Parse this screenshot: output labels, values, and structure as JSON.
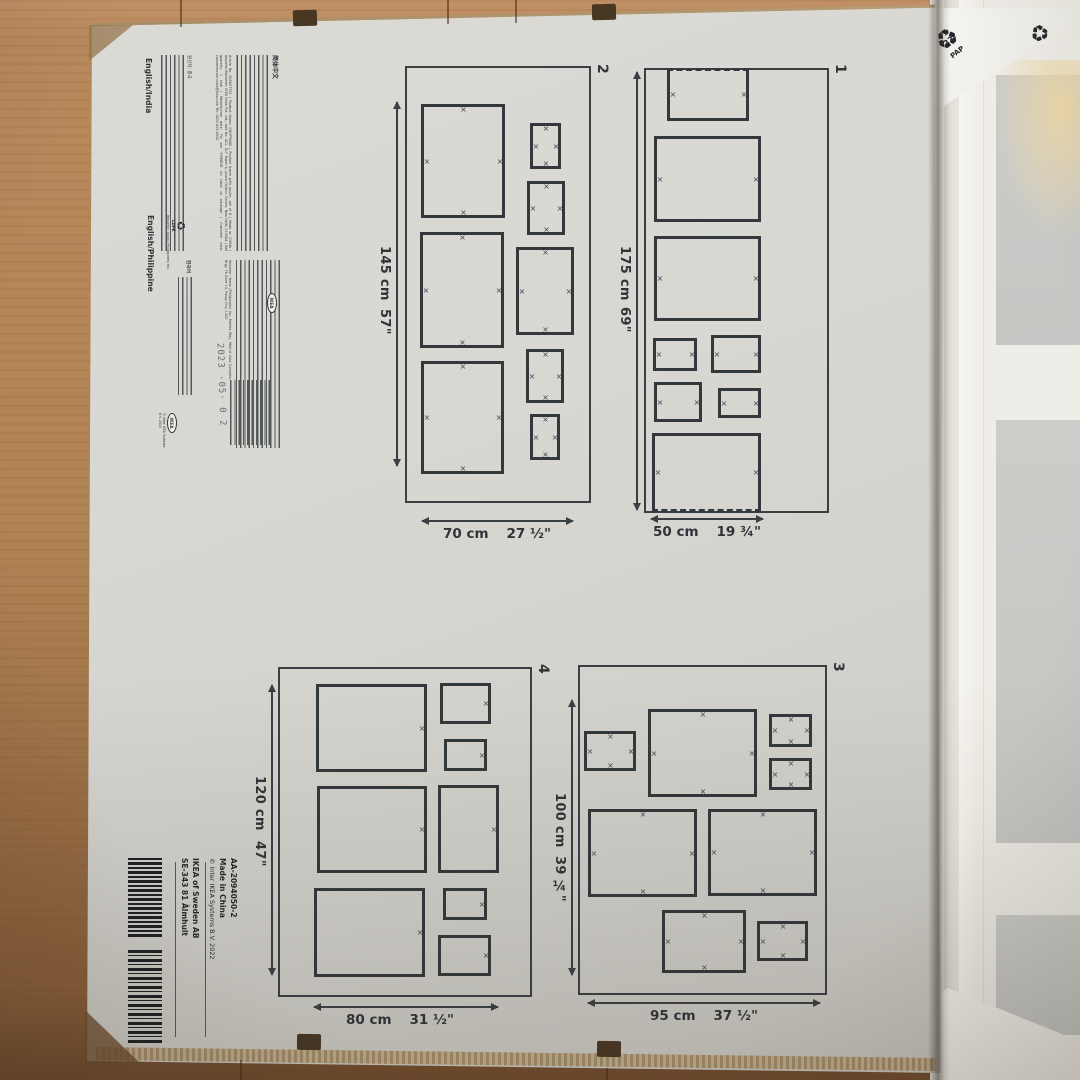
{
  "info_block": {
    "zh_header": "简体中文",
    "en_paragraph": "Article No. 605607791 | Product Name: KNOPPÄNG | Product frame with poster, set of 8 | Made in: CHINA | Importer/Marketer: IKEA India Pvt. Ltd., Unit No. 421, DLF Tower A, Jasola District Centre, New Delhi 110044 | Net quantity: 1 Unit | Manufacture date: Pls see YYMMDD on label or package | Customer care: customercare.india@ikea.com Tel: 1800-419-4532",
    "ph_paragraph": "Importer: Ikano (Philippines) Inc. Marina Way, Mall of Asia Complex, Brgy. 76 Zone 10, Pasay City, 1300",
    "kr_line": "한국어",
    "kr_origin": "원산지: 중국",
    "header_india": "English/India",
    "header_philippine": "English/Philippine",
    "importer_ph": "Importer: Ikano (Philippines) Inc.",
    "ldpe_label": "LDPE",
    "ldpe_code": "4",
    "date_stamp": "2023 ·05· 0 2",
    "ikea_logo": "IKEA",
    "copyright": "© Inter IKEA Systems B.V. 2015"
  },
  "barcode_block": {
    "article": "AA-2094050-2",
    "made_in": "Made in China",
    "copyright": "© Inter IKEA Systems B.V. 2022",
    "company": "IKEA of Sweden AB",
    "address": "SE-343 81 Älmhult"
  },
  "recycling": {
    "symbol": "♻",
    "pap_label": "PAP",
    "pap_code_22": "22",
    "pap_code_20": "20"
  },
  "templates": [
    {
      "number": "1",
      "box": {
        "left": 644,
        "top": 68,
        "width": 185,
        "height": 445
      },
      "marks": "lr",
      "rects": [
        {
          "x": 23,
          "y": 0,
          "w": 83,
          "h": 54,
          "wavy": "top"
        },
        {
          "x": 10,
          "y": 68,
          "w": 108,
          "h": 87
        },
        {
          "x": 10,
          "y": 168,
          "w": 108,
          "h": 86
        },
        {
          "x": 9,
          "y": 270,
          "w": 45,
          "h": 34
        },
        {
          "x": 67,
          "y": 267,
          "w": 51,
          "h": 39
        },
        {
          "x": 10,
          "y": 314,
          "w": 49,
          "h": 41
        },
        {
          "x": 74,
          "y": 320,
          "w": 44,
          "h": 31
        },
        {
          "x": 8,
          "y": 365,
          "w": 110,
          "h": 80,
          "wavy": "bottom"
        }
      ],
      "v_arrow": {
        "x": 636,
        "y1": 72,
        "y2": 510
      },
      "v_label": {
        "x": 617,
        "y_cm": 246,
        "y_in": 307,
        "cm": "175 cm",
        "in": "69\""
      },
      "h_arrow": {
        "y": 518,
        "x1": 651,
        "x2": 763
      },
      "h_label": {
        "cx": 707,
        "y": 524,
        "cm": "50 cm",
        "in": "19 ¾\""
      },
      "num_pos": {
        "x": 832,
        "y": 64
      }
    },
    {
      "number": "2",
      "box": {
        "left": 405,
        "top": 66,
        "width": 186,
        "height": 437
      },
      "marks": "tlrb",
      "rects": [
        {
          "x": 16,
          "y": 38,
          "w": 85,
          "h": 115
        },
        {
          "x": 125,
          "y": 57,
          "w": 32,
          "h": 47
        },
        {
          "x": 122,
          "y": 115,
          "w": 39,
          "h": 55
        },
        {
          "x": 15,
          "y": 166,
          "w": 85,
          "h": 117
        },
        {
          "x": 111,
          "y": 181,
          "w": 59,
          "h": 89
        },
        {
          "x": 121,
          "y": 283,
          "w": 39,
          "h": 55
        },
        {
          "x": 16,
          "y": 295,
          "w": 84,
          "h": 114
        },
        {
          "x": 125,
          "y": 348,
          "w": 31,
          "h": 47
        }
      ],
      "v_arrow": {
        "x": 396,
        "y1": 102,
        "y2": 466
      },
      "v_label": {
        "x": 377,
        "y_cm": 246,
        "y_in": 309,
        "cm": "145 cm",
        "in": "57\""
      },
      "h_arrow": {
        "y": 520,
        "x1": 422,
        "x2": 573
      },
      "h_label": {
        "cx": 497,
        "y": 526,
        "cm": "70 cm",
        "in": "27 ½\""
      },
      "num_pos": {
        "x": 594,
        "y": 64
      }
    },
    {
      "number": "3",
      "box": {
        "left": 578,
        "top": 665,
        "width": 249,
        "height": 330
      },
      "marks": "tlrb",
      "rects": [
        {
          "x": 6,
          "y": 66,
          "w": 53,
          "h": 41
        },
        {
          "x": 70,
          "y": 44,
          "w": 110,
          "h": 89
        },
        {
          "x": 191,
          "y": 49,
          "w": 44,
          "h": 34
        },
        {
          "x": 191,
          "y": 93,
          "w": 44,
          "h": 33
        },
        {
          "x": 10,
          "y": 144,
          "w": 110,
          "h": 89
        },
        {
          "x": 130,
          "y": 144,
          "w": 110,
          "h": 88
        },
        {
          "x": 84,
          "y": 245,
          "w": 85,
          "h": 64
        },
        {
          "x": 179,
          "y": 256,
          "w": 52,
          "h": 41
        }
      ],
      "v_arrow": {
        "x": 571,
        "y1": 700,
        "y2": 975
      },
      "v_label": {
        "x": 552,
        "y_cm": 793,
        "y_in": 856,
        "cm": "100 cm",
        "in": "39 ¼\""
      },
      "h_arrow": {
        "y": 1002,
        "x1": 588,
        "x2": 820
      },
      "h_label": {
        "cx": 704,
        "y": 1008,
        "cm": "95 cm",
        "in": "37 ½\""
      },
      "num_pos": {
        "x": 830,
        "y": 662
      }
    },
    {
      "number": "4",
      "box": {
        "left": 278,
        "top": 667,
        "width": 254,
        "height": 330
      },
      "marks": "r",
      "rects": [
        {
          "x": 38,
          "y": 17,
          "w": 112,
          "h": 89
        },
        {
          "x": 162,
          "y": 16,
          "w": 52,
          "h": 42
        },
        {
          "x": 166,
          "y": 72,
          "w": 44,
          "h": 33
        },
        {
          "x": 39,
          "y": 119,
          "w": 111,
          "h": 88
        },
        {
          "x": 160,
          "y": 118,
          "w": 62,
          "h": 89
        },
        {
          "x": 36,
          "y": 221,
          "w": 112,
          "h": 90
        },
        {
          "x": 165,
          "y": 221,
          "w": 45,
          "h": 33
        },
        {
          "x": 160,
          "y": 268,
          "w": 54,
          "h": 42
        }
      ],
      "v_arrow": {
        "x": 271,
        "y1": 685,
        "y2": 975
      },
      "v_label": {
        "x": 252,
        "y_cm": 776,
        "y_in": 841,
        "cm": "120 cm",
        "in": "47\""
      },
      "h_arrow": {
        "y": 1006,
        "x1": 314,
        "x2": 498
      },
      "h_label": {
        "cx": 400,
        "y": 1012,
        "cm": "80 cm",
        "in": "31 ½\""
      },
      "num_pos": {
        "x": 535,
        "y": 664
      }
    }
  ]
}
